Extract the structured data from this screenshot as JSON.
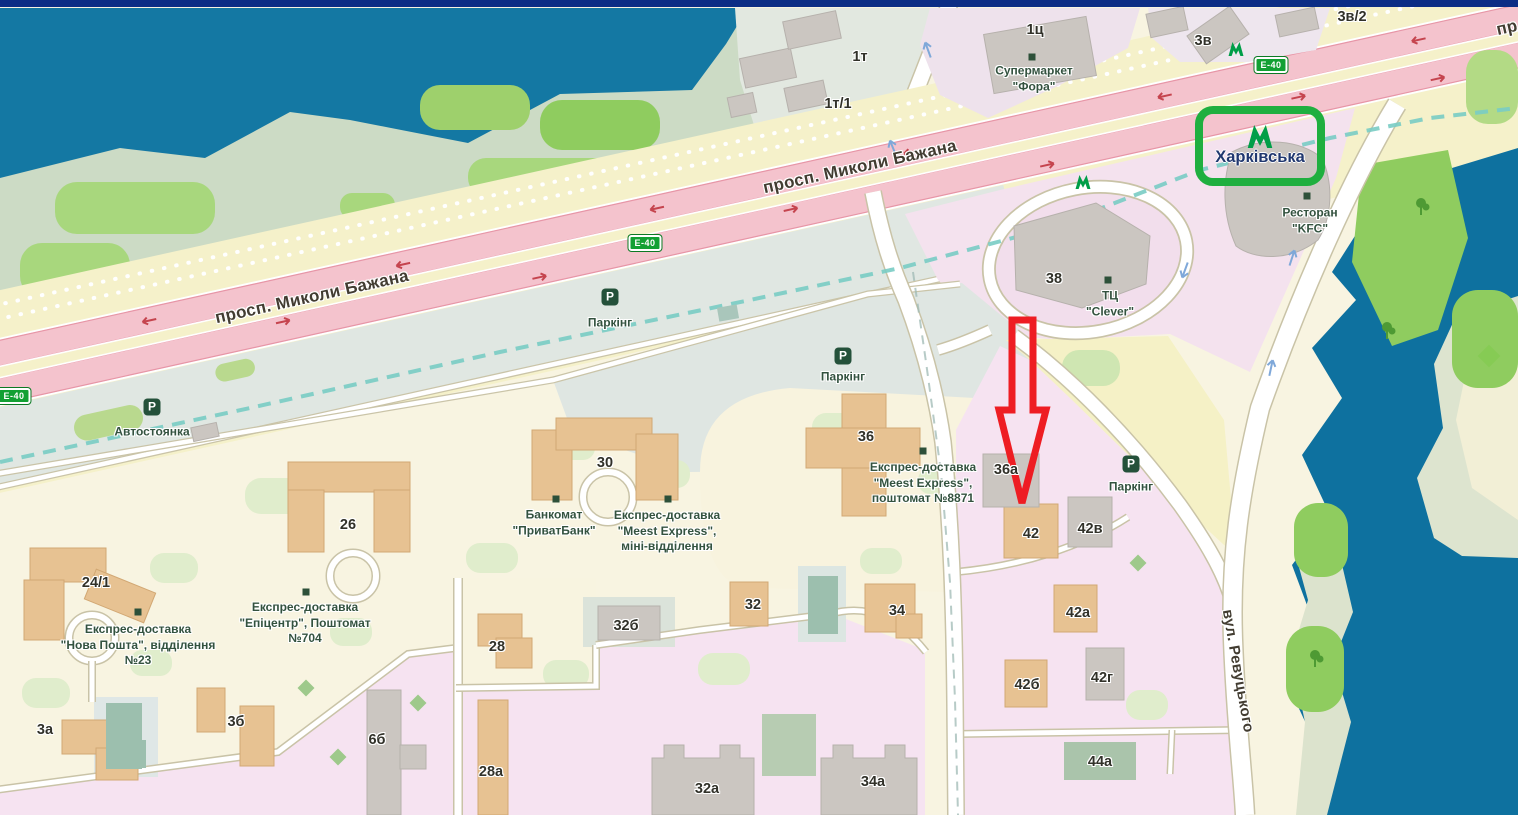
{
  "colors": {
    "water": "#1478a3",
    "water_right": "#0e719f",
    "highway_pink": "#f4c3cd",
    "parking_zone_grey": "#e0e7e2",
    "pink_district": "#f6e3f1",
    "metro_green": "#009e48",
    "route_sign_green": "#12a033",
    "poi_text_green": "#33523f",
    "annotation_arrow_red": "#ee1d23",
    "annotation_box_green": "#1faf3f",
    "top_bar_navy": "#0c2d85"
  },
  "streets": {
    "bazhana": "просп. Миколи Бажана",
    "bazhana_clipped": "пр",
    "revutskoho": "вул. Ревуцького",
    "route_e40": "E-40"
  },
  "metro": {
    "station_name": "Харківська"
  },
  "parking": {
    "p_glyph": "P",
    "avtostoyanka": "Автостоянка",
    "parking_label": "Паркінг"
  },
  "buildings": {
    "k1t": "1т",
    "k1t1": "1т/1",
    "k1c": "1ц",
    "k3v": "3в",
    "k3v2": "3в/2",
    "k38": "38",
    "k26": "26",
    "k241": "24/1",
    "k30": "30",
    "k3a": "3а",
    "k3b": "3б",
    "k6b": "6б",
    "k28": "28",
    "k28a": "28а",
    "k32b": "32б",
    "k32": "32",
    "k32a": "32а",
    "k34": "34",
    "k34a": "34а",
    "k36": "36",
    "k36a": "36а",
    "k42": "42",
    "k42v": "42в",
    "k42a": "42а",
    "k42b": "42б",
    "k42g": "42г",
    "k44a": "44а"
  },
  "pois": {
    "fora": {
      "line1": "Супермаркет",
      "line2": "\"Фора\""
    },
    "kfc": {
      "line1": "Ресторан",
      "line2": "\"KFC\""
    },
    "clever": {
      "line1": "ТЦ",
      "line2": "\"Clever\""
    },
    "nova_poshta": {
      "line1": "Експрес-доставка",
      "line2": "\"Нова Пошта\", відділення",
      "line3": "№23"
    },
    "epicentr": {
      "line1": "Експрес-доставка",
      "line2": "\"Епіцентр\", Поштомат",
      "line3": "№704"
    },
    "privatbank": {
      "line1": "Банкомат",
      "line2": "\"ПриватБанк\""
    },
    "meest_mini": {
      "line1": "Експрес-доставка",
      "line2": "\"Meest Express\",",
      "line3": "міні-відділення"
    },
    "meest_postomat": {
      "line1": "Експрес-доставка",
      "line2": "\"Meest Express\",",
      "line3": "поштомат №8871"
    }
  }
}
